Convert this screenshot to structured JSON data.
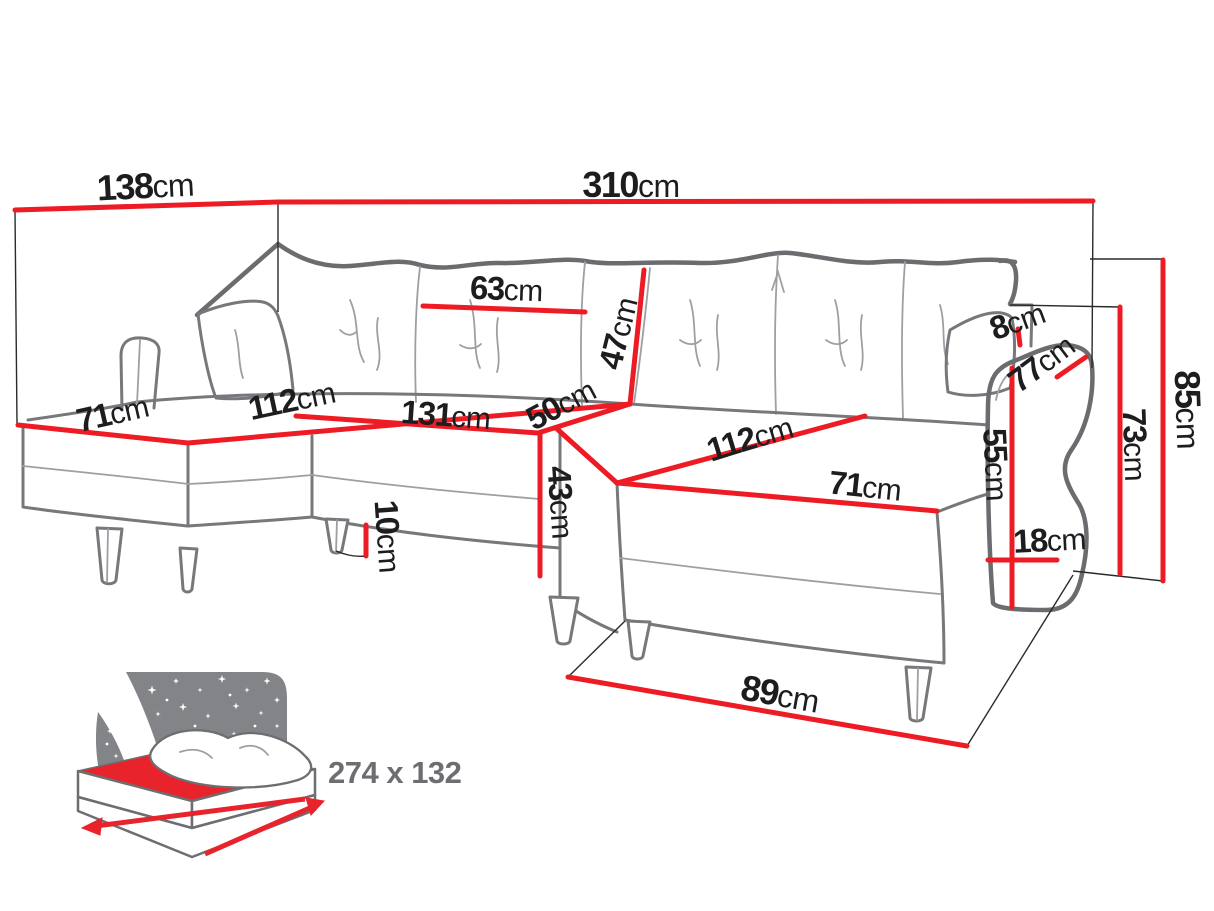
{
  "diagram": {
    "subject": "U-shaped corner sofa bed dimension diagram",
    "colors": {
      "dimension_line": "#ed1c24",
      "sketch_outline": "#77787b",
      "label_text": "#1d1d1f",
      "icon_gray": "#828487",
      "icon_text": "#6d6e71"
    },
    "measurements": {
      "back_width_left": {
        "value": "138",
        "unit": "cm"
      },
      "back_width_total": {
        "value": "310",
        "unit": "cm"
      },
      "back_cushion_width": {
        "value": "63",
        "unit": "cm"
      },
      "back_cushion_height": {
        "value": "47",
        "unit": "cm"
      },
      "left_chaise_width": {
        "value": "71",
        "unit": "cm"
      },
      "left_chaise_length": {
        "value": "112",
        "unit": "cm"
      },
      "middle_seat_width": {
        "value": "131",
        "unit": "cm"
      },
      "seat_depth": {
        "value": "50",
        "unit": "cm"
      },
      "right_chaise_length": {
        "value": "112",
        "unit": "cm"
      },
      "right_chaise_width": {
        "value": "71",
        "unit": "cm"
      },
      "seat_height": {
        "value": "43",
        "unit": "cm"
      },
      "leg_height": {
        "value": "10",
        "unit": "cm"
      },
      "arm_back_gap": {
        "value": "8",
        "unit": "cm"
      },
      "arm_diagonal_depth": {
        "value": "77",
        "unit": "cm"
      },
      "arm_front_height": {
        "value": "55",
        "unit": "cm"
      },
      "arm_width": {
        "value": "18",
        "unit": "cm"
      },
      "back_height": {
        "value": "73",
        "unit": "cm"
      },
      "total_height": {
        "value": "85",
        "unit": "cm"
      },
      "ottoman_width": {
        "value": "89",
        "unit": "cm"
      }
    },
    "sleeping_area": {
      "label": "274 x 132"
    }
  }
}
